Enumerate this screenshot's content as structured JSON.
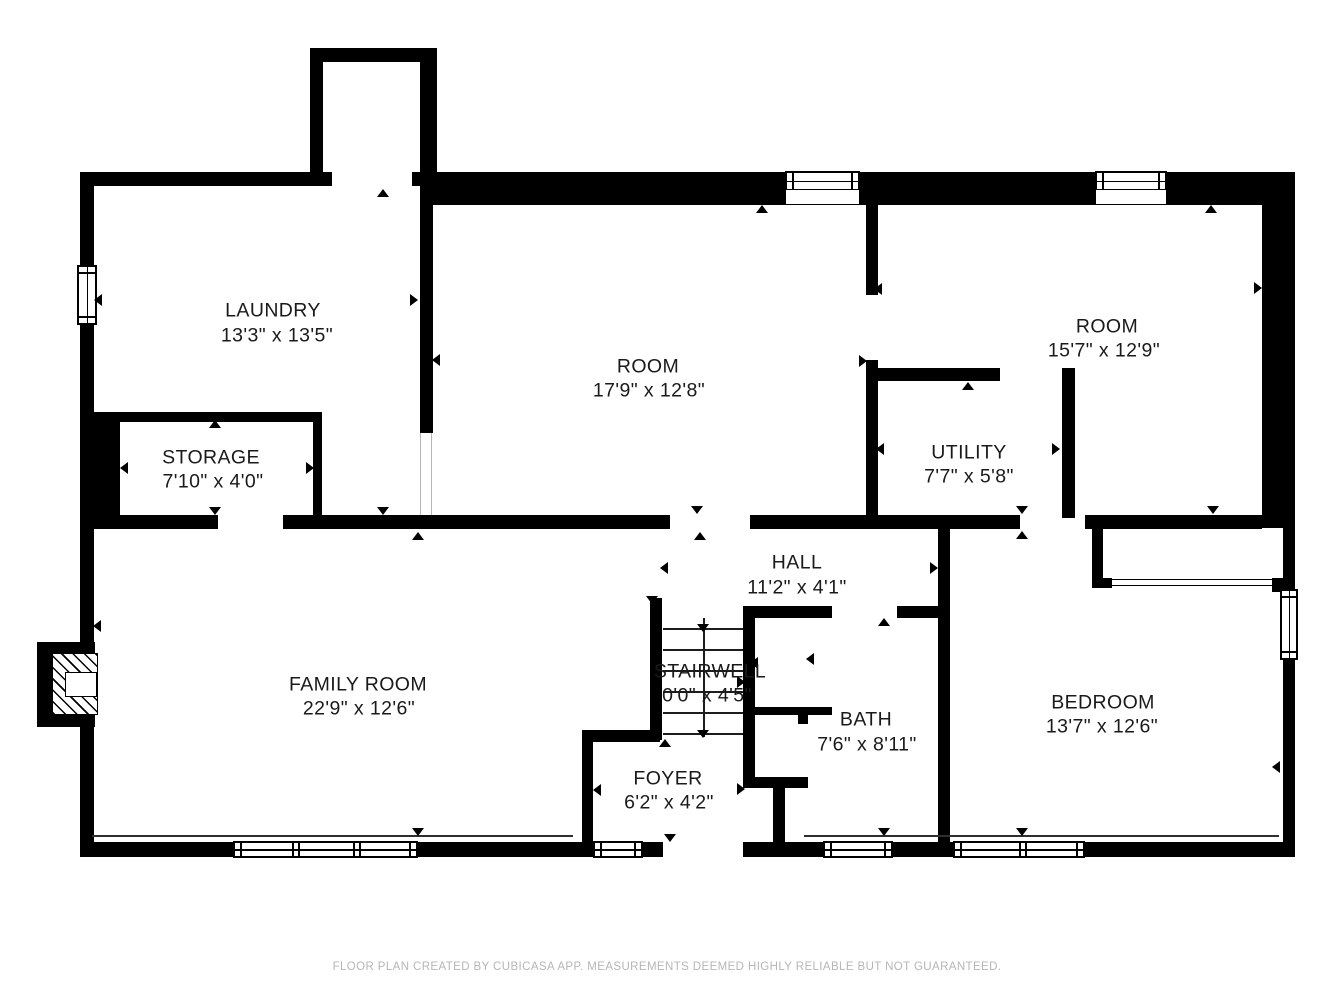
{
  "footer": "FLOOR PLAN CREATED BY CUBICASA APP. MEASUREMENTS DEEMED HIGHLY RELIABLE BUT NOT GUARANTEED.",
  "colors": {
    "wall": "#000000",
    "text": "#1a1a1a",
    "footer_text": "#b6b6b6",
    "background": "#ffffff"
  },
  "rooms": [
    {
      "id": "laundry",
      "name": "LAUNDRY",
      "dims": "13'3\" x 13'5\"",
      "nx": 273,
      "ny": 311,
      "dx": 277,
      "dy": 336
    },
    {
      "id": "storage",
      "name": "STORAGE",
      "dims": "7'10\" x 4'0\"",
      "nx": 211,
      "ny": 458,
      "dx": 213,
      "dy": 482
    },
    {
      "id": "room-center",
      "name": "ROOM",
      "dims": "17'9\" x 12'8\"",
      "nx": 648,
      "ny": 367,
      "dx": 649,
      "dy": 391
    },
    {
      "id": "room-right",
      "name": "ROOM",
      "dims": "15'7\" x 12'9\"",
      "nx": 1107,
      "ny": 327,
      "dx": 1104,
      "dy": 351
    },
    {
      "id": "utility",
      "name": "UTILITY",
      "dims": "7'7\" x 5'8\"",
      "nx": 969,
      "ny": 453,
      "dx": 969,
      "dy": 477
    },
    {
      "id": "hall",
      "name": "HALL",
      "dims": "11'2\" x 4'1\"",
      "nx": 797,
      "ny": 563,
      "dx": 797,
      "dy": 588
    },
    {
      "id": "family-room",
      "name": "FAMILY ROOM",
      "dims": "22'9\" x 12'6\"",
      "nx": 358,
      "ny": 685,
      "dx": 359,
      "dy": 709
    },
    {
      "id": "stairwell",
      "name": "STAIRWELL",
      "dims": "0'0\" x 4'5\"",
      "nx": 710,
      "ny": 672,
      "dx": 707,
      "dy": 696
    },
    {
      "id": "bath",
      "name": "BATH",
      "dims": "7'6\" x 8'11\"",
      "nx": 866,
      "ny": 720,
      "dx": 867,
      "dy": 745
    },
    {
      "id": "foyer",
      "name": "FOYER",
      "dims": "6'2\" x 4'2\"",
      "nx": 668,
      "ny": 779,
      "dx": 669,
      "dy": 803
    },
    {
      "id": "bedroom",
      "name": "BEDROOM",
      "dims": "13'7\" x 12'6\"",
      "nx": 1103,
      "ny": 703,
      "dx": 1102,
      "dy": 727
    }
  ],
  "floorplan": {
    "walls": [
      [
        80,
        172,
        14,
        685
      ],
      [
        80,
        172,
        230,
        14
      ],
      [
        310,
        48,
        13,
        138
      ],
      [
        310,
        48,
        127,
        14
      ],
      [
        420,
        48,
        17,
        157
      ],
      [
        323,
        172,
        9,
        14
      ],
      [
        412,
        172,
        8,
        14
      ],
      [
        437,
        172,
        858,
        33
      ],
      [
        1262,
        172,
        33,
        356
      ],
      [
        1283,
        528,
        12,
        329
      ],
      [
        80,
        842,
        583,
        15
      ],
      [
        743,
        842,
        552,
        15
      ],
      [
        80,
        412,
        242,
        10
      ],
      [
        94,
        422,
        26,
        95
      ],
      [
        313,
        412,
        9,
        105
      ],
      [
        420,
        186,
        13,
        247
      ],
      [
        94,
        515,
        124,
        14
      ],
      [
        283,
        515,
        387,
        14
      ],
      [
        750,
        515,
        270,
        14
      ],
      [
        1085,
        515,
        177,
        14
      ],
      [
        866,
        205,
        12,
        90
      ],
      [
        866,
        360,
        12,
        158
      ],
      [
        866,
        368,
        134,
        13
      ],
      [
        1062,
        368,
        13,
        150
      ],
      [
        650,
        598,
        12,
        142
      ],
      [
        743,
        606,
        12,
        182
      ],
      [
        743,
        606,
        89,
        12
      ],
      [
        897,
        606,
        41,
        12
      ],
      [
        938,
        529,
        12,
        313
      ],
      [
        755,
        707,
        77,
        8
      ],
      [
        798,
        715,
        10,
        9
      ],
      [
        743,
        777,
        65,
        11
      ],
      [
        773,
        788,
        12,
        54
      ],
      [
        582,
        730,
        11,
        112
      ],
      [
        582,
        730,
        78,
        12
      ],
      [
        1092,
        528,
        11,
        60
      ],
      [
        1103,
        578,
        9,
        10
      ],
      [
        1272,
        578,
        11,
        14
      ]
    ],
    "windows": [
      {
        "x": 77,
        "y": 265,
        "w": 20,
        "h": 60,
        "o": "v"
      },
      {
        "x": 785,
        "y": 171,
        "w": 75,
        "h": 20,
        "o": "h",
        "recess": 14
      },
      {
        "x": 1095,
        "y": 171,
        "w": 72,
        "h": 20,
        "o": "h",
        "recess": 14
      },
      {
        "x": 1280,
        "y": 589,
        "w": 18,
        "h": 71,
        "o": "v"
      },
      {
        "x": 233,
        "y": 841,
        "w": 185,
        "h": 17,
        "o": "h",
        "mullions": [
          59,
          120
        ]
      },
      {
        "x": 593,
        "y": 841,
        "w": 50,
        "h": 17,
        "o": "h"
      },
      {
        "x": 823,
        "y": 841,
        "w": 70,
        "h": 17,
        "o": "h"
      },
      {
        "x": 953,
        "y": 841,
        "w": 132,
        "h": 17,
        "o": "h",
        "mullions": [
          66
        ]
      }
    ],
    "sills": [
      [
        92,
        835,
        481
      ],
      [
        804,
        835,
        475
      ]
    ],
    "jambs": [
      [
        420,
        433,
        82
      ],
      [
        431,
        433,
        82
      ]
    ],
    "markers": [
      [
        383,
        193,
        "up"
      ],
      [
        98,
        300,
        "left"
      ],
      [
        414,
        300,
        "right"
      ],
      [
        436,
        360,
        "left"
      ],
      [
        215,
        424,
        "up"
      ],
      [
        124,
        468,
        "left"
      ],
      [
        310,
        468,
        "right"
      ],
      [
        215,
        511,
        "down"
      ],
      [
        383,
        511,
        "down"
      ],
      [
        418,
        536,
        "up"
      ],
      [
        762,
        209,
        "up"
      ],
      [
        1211,
        209,
        "up"
      ],
      [
        697,
        510,
        "down"
      ],
      [
        700,
        536,
        "up"
      ],
      [
        878,
        289,
        "left"
      ],
      [
        863,
        361,
        "right"
      ],
      [
        968,
        386,
        "up"
      ],
      [
        880,
        449,
        "left"
      ],
      [
        1056,
        449,
        "right"
      ],
      [
        1258,
        288,
        "right"
      ],
      [
        1213,
        510,
        "down"
      ],
      [
        1022,
        510,
        "down"
      ],
      [
        1022,
        535,
        "up"
      ],
      [
        884,
        622,
        "up"
      ],
      [
        810,
        659,
        "left"
      ],
      [
        664,
        568,
        "left"
      ],
      [
        934,
        568,
        "right"
      ],
      [
        652,
        600,
        "down"
      ],
      [
        665,
        743,
        "up"
      ],
      [
        597,
        790,
        "left"
      ],
      [
        741,
        789,
        "right"
      ],
      [
        754,
        663,
        "left"
      ],
      [
        741,
        682,
        "right"
      ],
      [
        97,
        626,
        "left"
      ],
      [
        1276,
        767,
        "left"
      ],
      [
        418,
        832,
        "down"
      ],
      [
        884,
        832,
        "down"
      ],
      [
        1022,
        832,
        "down"
      ],
      [
        670,
        838,
        "down"
      ],
      [
        703,
        628,
        "down"
      ],
      [
        703,
        734,
        "down"
      ]
    ],
    "stairs": {
      "x": 663,
      "y": 618,
      "w": 80,
      "h": 119,
      "treads": [
        628,
        649,
        670,
        691,
        712,
        733
      ],
      "center_x": 703
    },
    "fireplace": {
      "outer": [
        37,
        642,
        58,
        85
      ],
      "hatch": [
        52,
        653,
        46,
        62
      ],
      "notch": [
        65,
        672,
        32,
        25
      ]
    },
    "closet_door": [
      1112,
      579,
      160,
      7
    ]
  }
}
